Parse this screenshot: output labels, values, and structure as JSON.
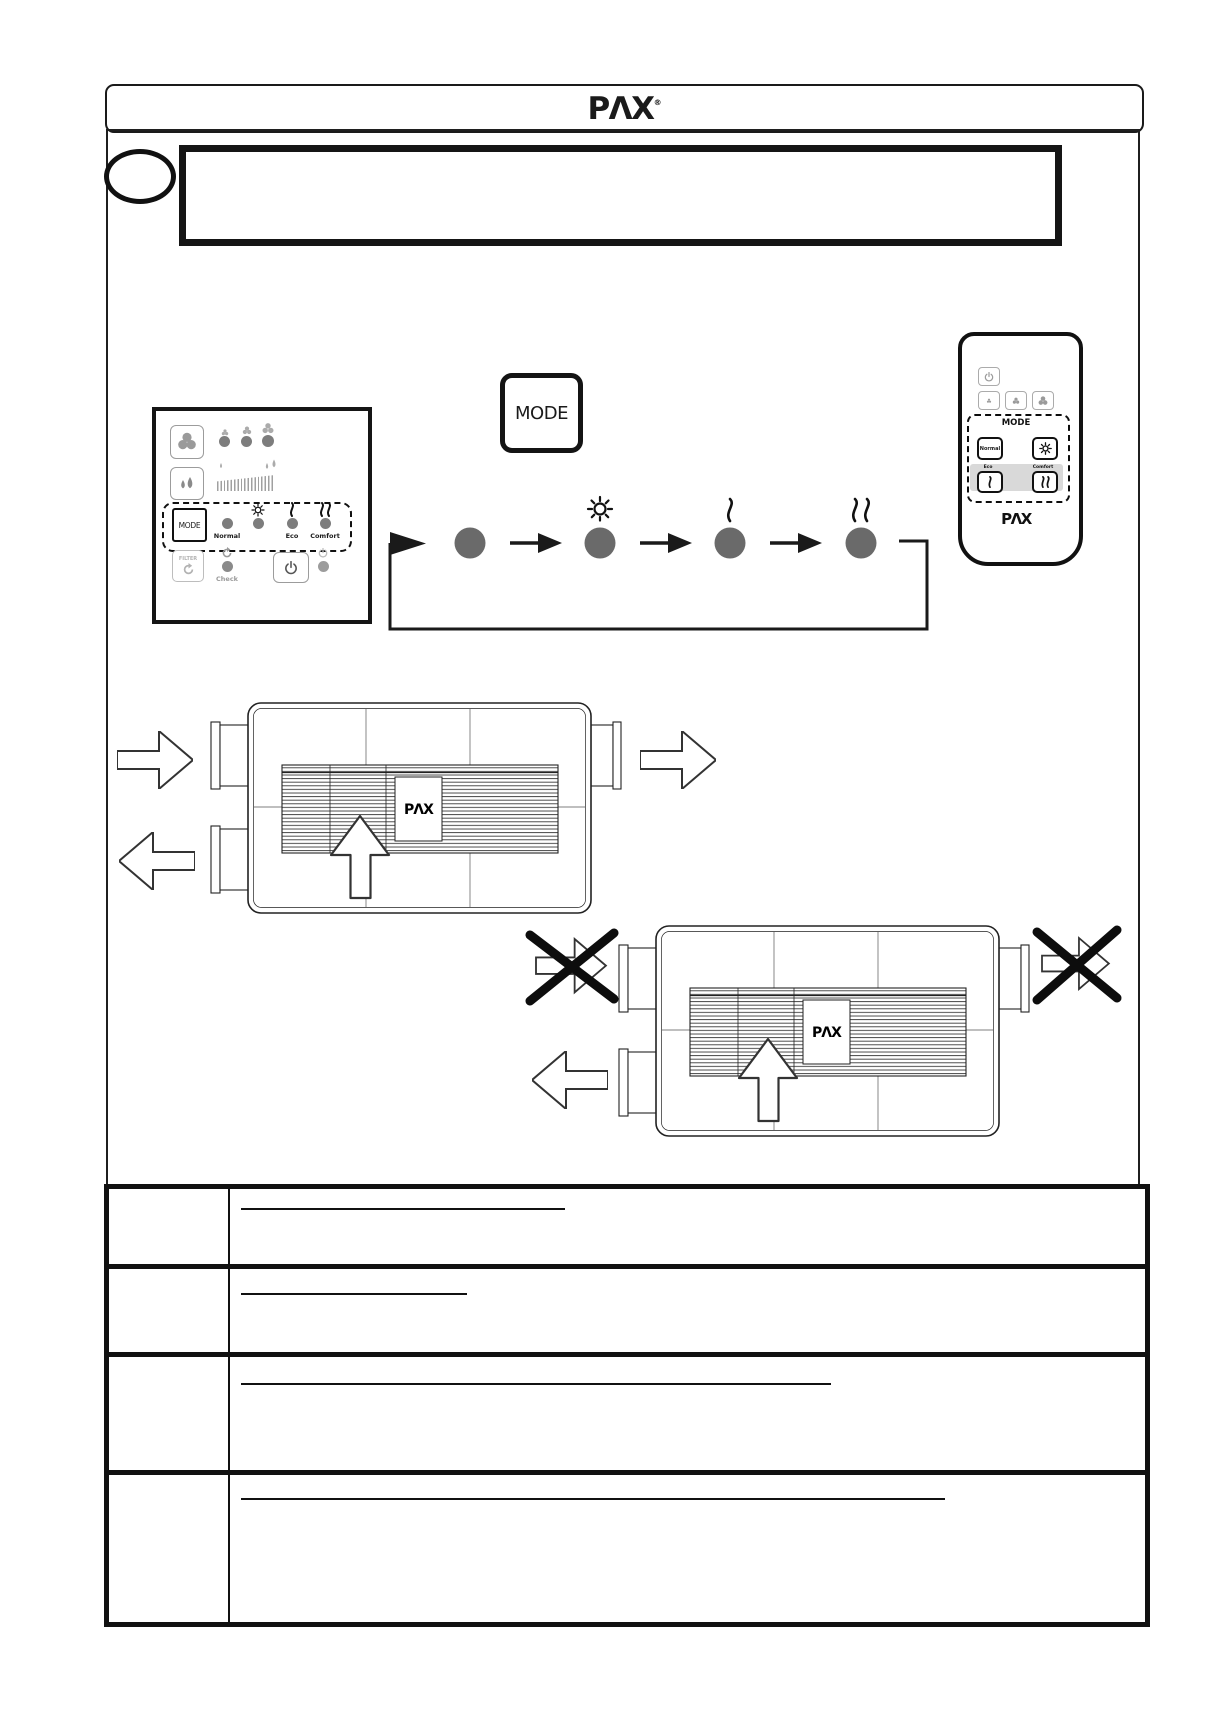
{
  "brand": {
    "logo": "PΛX",
    "registered": "®"
  },
  "title_box": {
    "text": ""
  },
  "control_panel": {
    "mode_button": "MODE",
    "led_labels": {
      "normal": "Normal",
      "eco": "Eco",
      "comfort": "Comfort"
    },
    "led_icons": [
      "none",
      "sun-icon",
      "single-wave-icon",
      "double-wave-icon"
    ],
    "fan_speed_leds": 3,
    "filter_button": "FILTER",
    "check_label": "Check"
  },
  "mode_sequence": {
    "mode_button": "MODE",
    "steps": [
      {
        "icon": "none"
      },
      {
        "icon": "sun-icon"
      },
      {
        "icon": "single-wave-icon"
      },
      {
        "icon": "double-wave-icon"
      }
    ],
    "loops": true
  },
  "remote": {
    "section_label": "MODE",
    "buttons": {
      "normal": "Normal"
    },
    "labels": {
      "eco": "Eco",
      "comfort": "Comfort"
    }
  },
  "unit_diagram": {
    "label": "PΛX"
  },
  "table": {
    "rows": [
      {
        "heading": ""
      },
      {
        "heading": ""
      },
      {
        "heading": ""
      },
      {
        "heading": ""
      }
    ]
  },
  "colors": {
    "ink": "#1a1a1a",
    "led_gray": "#7d7d7d",
    "step_circle": "#6a6a6a",
    "remote_band": "#d9d9d9"
  }
}
